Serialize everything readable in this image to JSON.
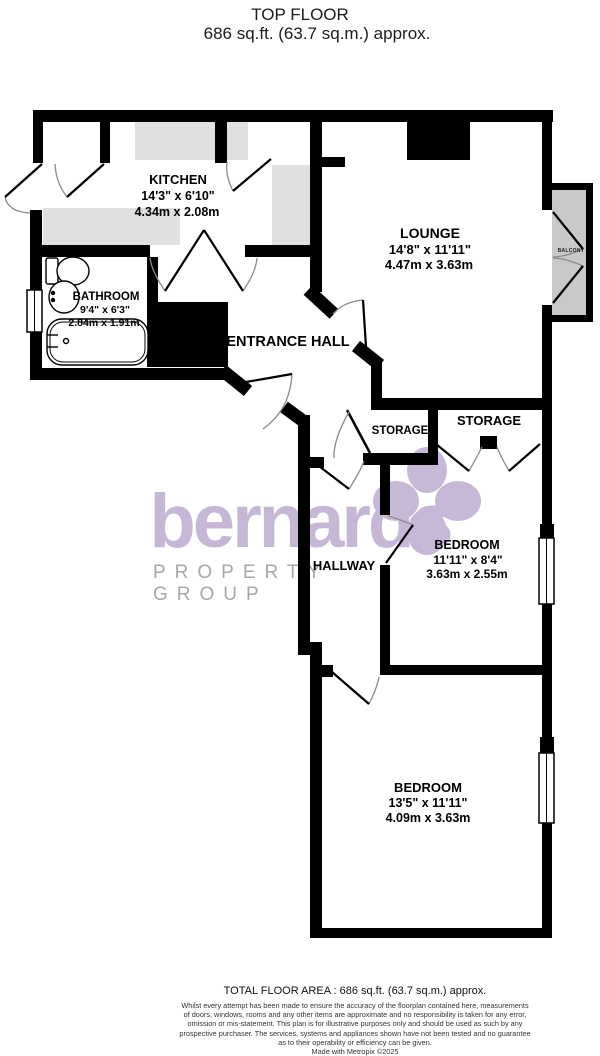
{
  "title": {
    "line1": "TOP FLOOR",
    "line2": "686 sq.ft. (63.7 sq.m.) approx."
  },
  "rooms": {
    "kitchen": {
      "name": "KITCHEN",
      "imperial": "14'3\"  x 6'10\"",
      "metric": "4.34m  x 2.08m"
    },
    "lounge": {
      "name": "LOUNGE",
      "imperial": "14'8\"  x 11'11\"",
      "metric": "4.47m  x 3.63m"
    },
    "bathroom": {
      "name": "BATHROOM",
      "imperial": "9'4\"  x 6'3\"",
      "metric": "2.84m  x 1.91m"
    },
    "entrance_hall": {
      "name": "ENTRANCE HALL"
    },
    "storage_left": {
      "name": "STORAGE"
    },
    "storage_right": {
      "name": "STORAGE"
    },
    "hallway": {
      "name": "HALLWAY"
    },
    "bedroom1": {
      "name": "BEDROOM",
      "imperial": "11'11\"  x 8'4\"",
      "metric": "3.63m  x 2.55m"
    },
    "bedroom2": {
      "name": "BEDROOM",
      "imperial": "13'5\"  x 11'11\"",
      "metric": "4.09m  x 3.63m"
    },
    "balcony": {
      "name": "BALCONY"
    }
  },
  "watermark": {
    "brand": "bernards",
    "tagline": "PROPERTY GROUP"
  },
  "footer": {
    "total": "TOTAL FLOOR AREA : 686 sq.ft. (63.7 sq.m.) approx.",
    "lines": [
      "Whilst every attempt has been made to ensure the accuracy of the floorplan contained here, measurements",
      "of doors, windows, rooms and any other items are approximate and no responsibility is taken for any error,",
      "omission or mis-statement. This plan is for illustrative purposes only and should be used as such by any",
      "prospective purchaser. The services, systems and appliances shown have not been tested and no guarantee",
      "as to their operability or efficiency can be given.",
      "Made with Metropix ©2025"
    ]
  },
  "colors": {
    "wall": "#000000",
    "counter_gray": "#e0e0e0",
    "balcony_gray": "#c9c9c9",
    "watermark_purple": "#c7b7d6",
    "tagline_gray": "#a9a5ad"
  }
}
